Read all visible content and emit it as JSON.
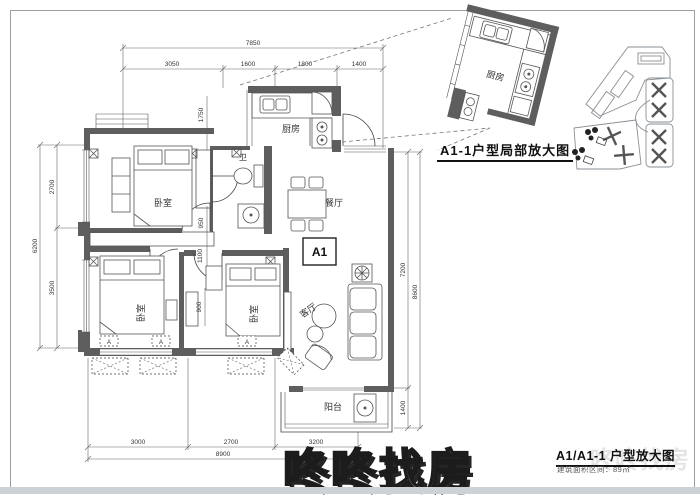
{
  "watermark": {
    "text": "咚咚找房"
  },
  "titles": {
    "detail": "A1-1户型局部放大图",
    "sheet": "A1/A1-1 户型放大图",
    "sheet_sub": "建筑面积区间：89㎡"
  },
  "unit": {
    "label": "A1",
    "ac_label": "A"
  },
  "rooms": {
    "bedroom": "卧室",
    "kitchen": "厨房",
    "bath": "卫",
    "dining": "餐厅",
    "living": "客厅",
    "balcony": "阳台"
  },
  "dims": {
    "top_total": "7850",
    "top": [
      "3050",
      "1600",
      "1800",
      "1400"
    ],
    "left_total": "6200",
    "left": [
      "2700",
      "3500"
    ],
    "right_total": "8600",
    "right": [
      "7200",
      "1400"
    ],
    "bottom_total": "8900",
    "bottom": [
      "3000",
      "2700",
      "3200"
    ],
    "inner": {
      "a": "1750",
      "b": "950",
      "c": "1100",
      "d": "900"
    }
  },
  "colors": {
    "wall": "#5e5e5e",
    "line": "#444444",
    "dim_text": "#333333",
    "frame": "#9aa0a5"
  }
}
